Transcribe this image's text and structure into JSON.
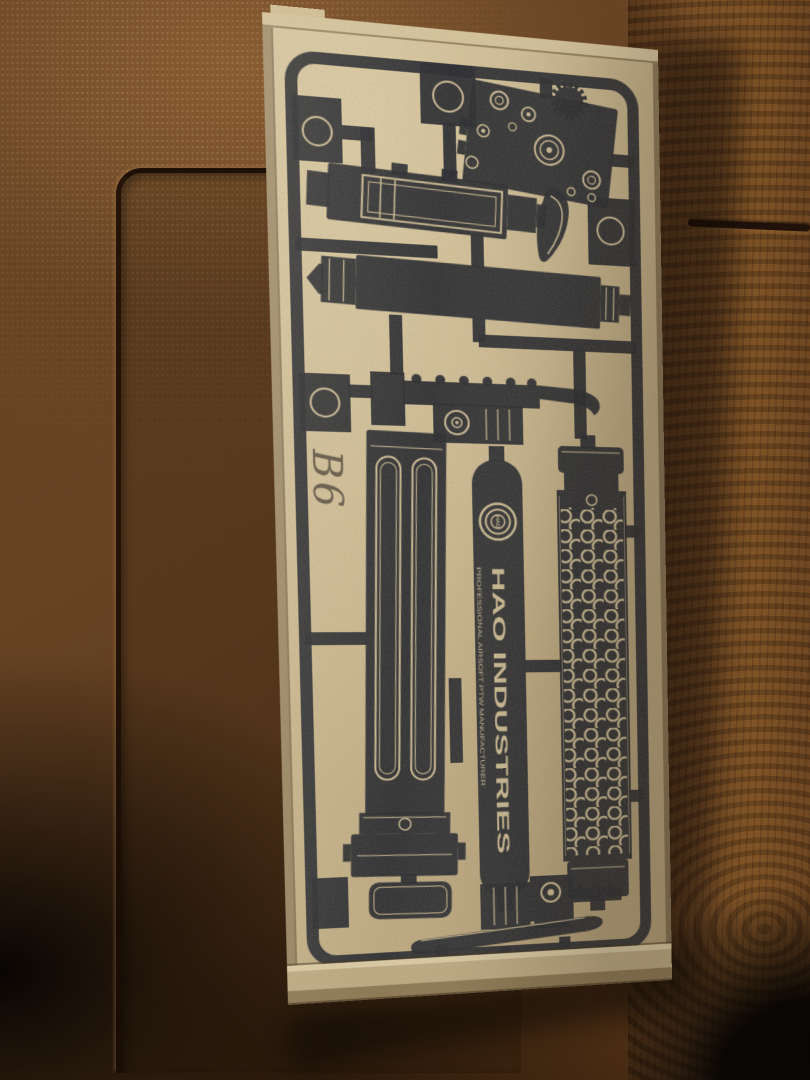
{
  "photo": {
    "handwritten_label": "B6",
    "brand": {
      "logo_text": "HAO",
      "title": "HAO INDUSTRIES",
      "subtitle": "PROFESSIONAL AIRSOFT PTW MANUFACTURER"
    }
  },
  "colors": {
    "ink": "#262930",
    "kraft": "#cdb98f",
    "kraft-light": "#e2d2ab",
    "kraft-dark": "#b5a078",
    "tan": "#d5c49c",
    "wood-base": "#6b4524",
    "wood-dark": "#2c1a0d",
    "wood-light": "#8a5a2e",
    "pen": "#4e443a"
  }
}
